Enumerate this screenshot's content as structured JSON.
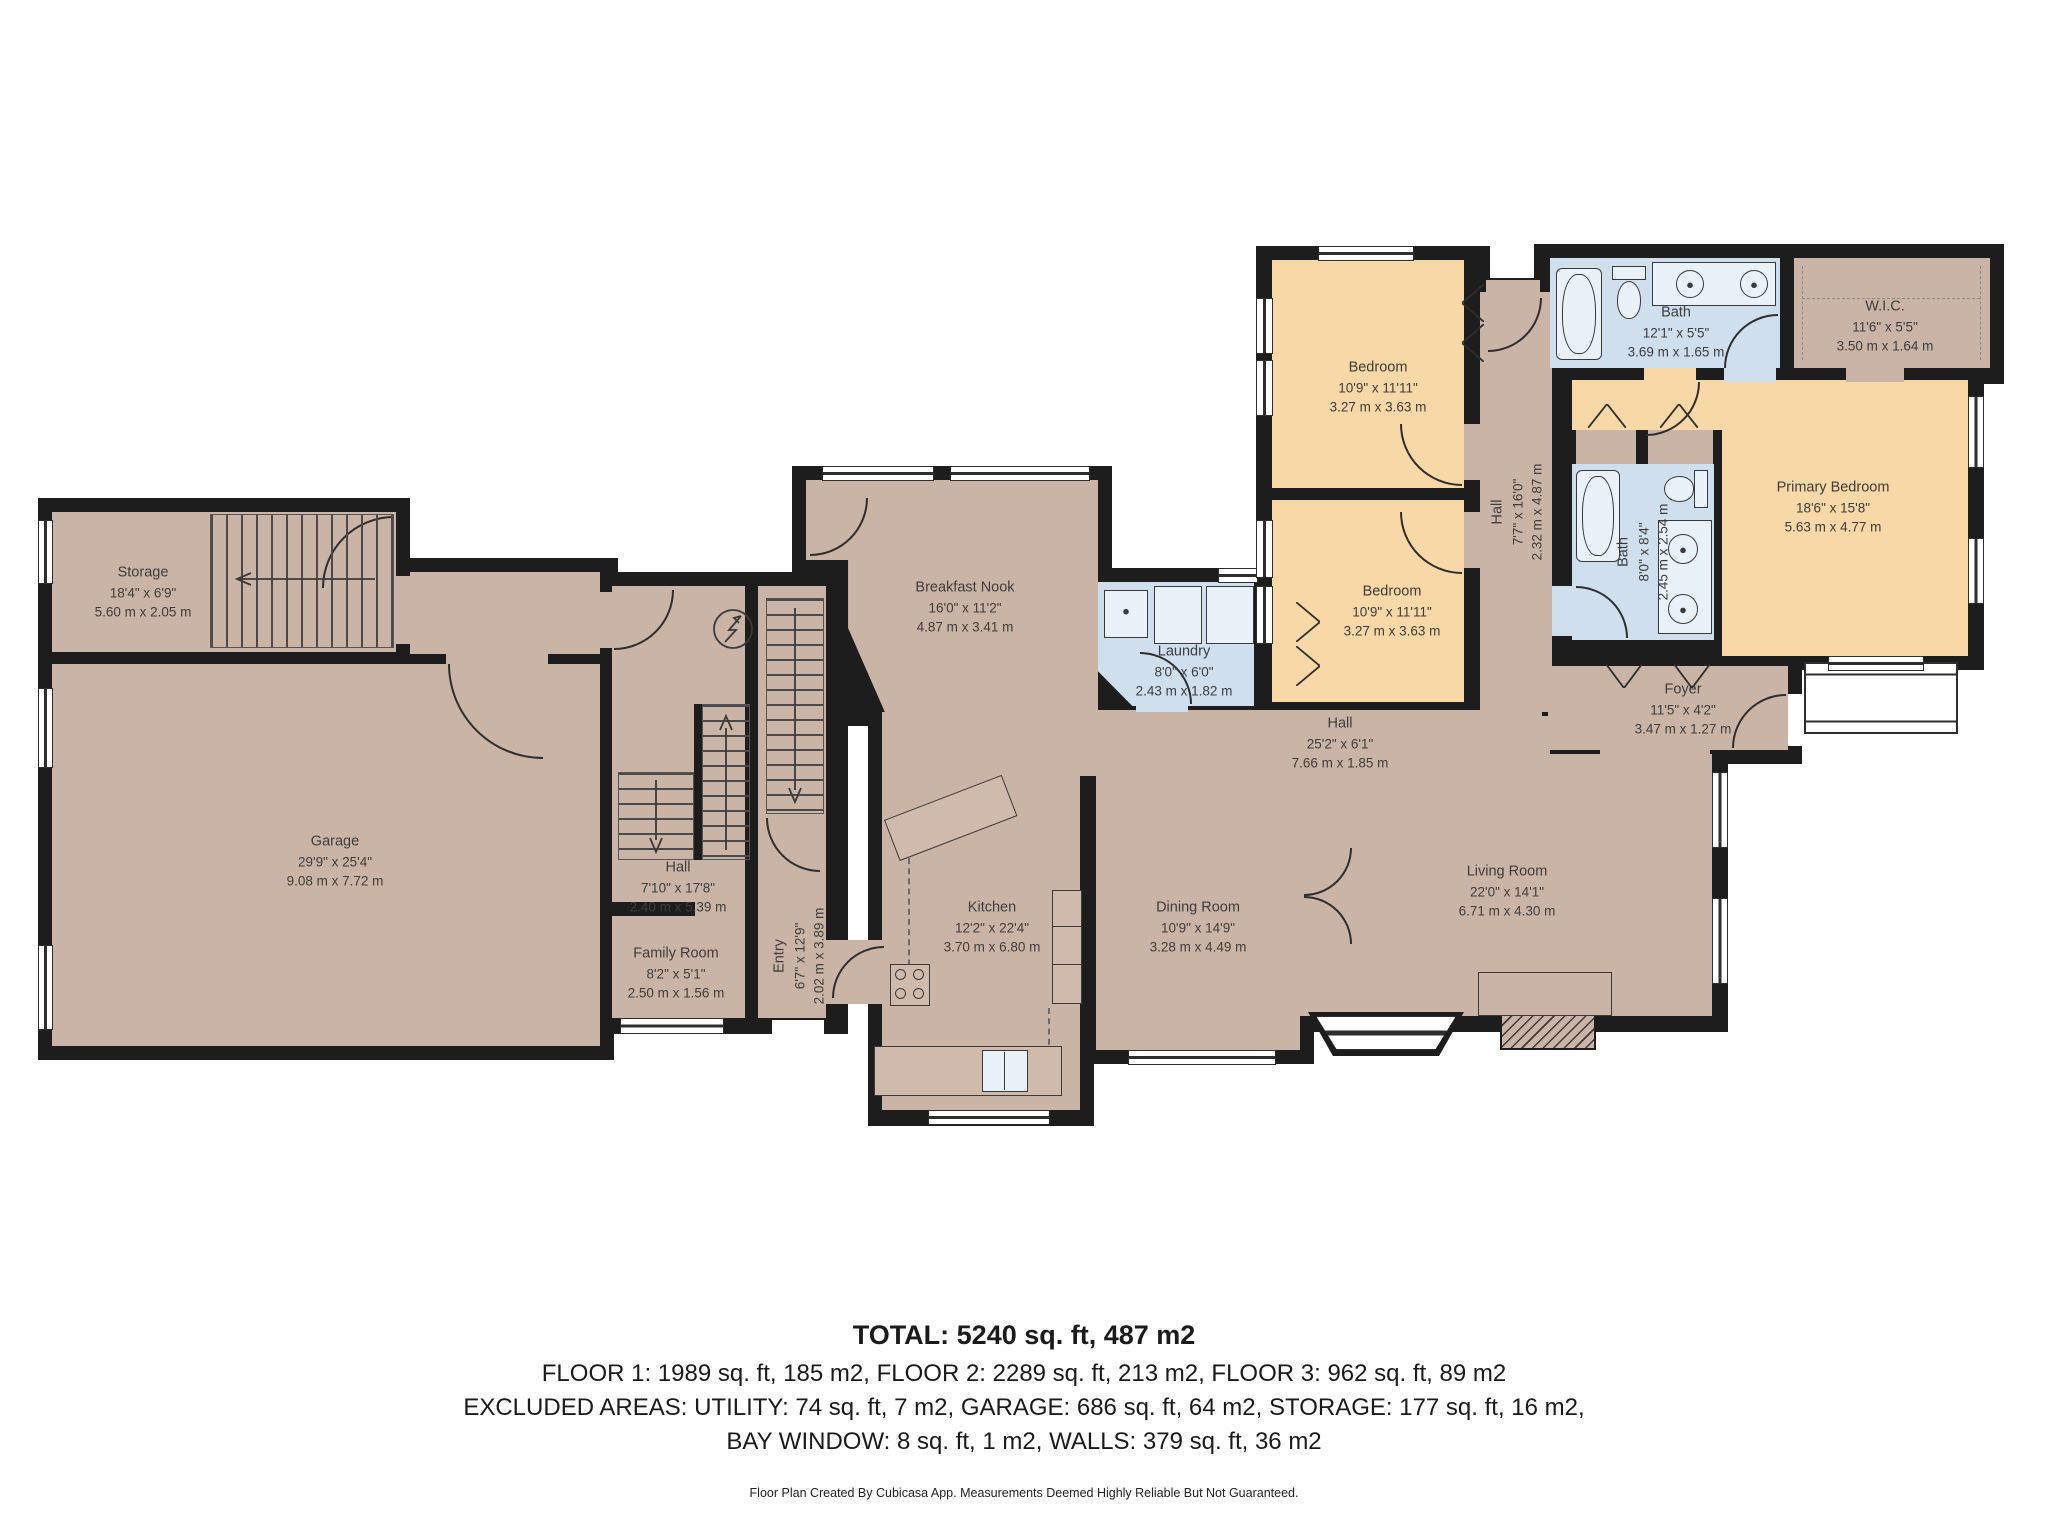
{
  "colors": {
    "wall": "#1d1d1d",
    "room": "#cab4a6",
    "bedroom": "#f7d8a6",
    "wet": "#cfdfee",
    "text": "#3d3d3d"
  },
  "rooms": {
    "storage": {
      "name": "Storage",
      "imperial": "18'4\" x 6'9\"",
      "metric": "5.60 m x 2.05 m"
    },
    "garage": {
      "name": "Garage",
      "imperial": "29'9\" x 25'4\"",
      "metric": "9.08 m x 7.72 m"
    },
    "hall_left": {
      "name": "Hall",
      "imperial": "7'10\" x 17'8\"",
      "metric": "2.40 m x 5.39 m"
    },
    "family_room": {
      "name": "Family Room",
      "imperial": "8'2\" x 5'1\"",
      "metric": "2.50 m x 1.56 m"
    },
    "entry": {
      "name": "Entry",
      "imperial": "6'7\" x 12'9\"",
      "metric": "2.02 m x 3.89 m"
    },
    "breakfast_nook": {
      "name": "Breakfast Nook",
      "imperial": "16'0\" x 11'2\"",
      "metric": "4.87 m x 3.41 m"
    },
    "kitchen": {
      "name": "Kitchen",
      "imperial": "12'2\" x 22'4\"",
      "metric": "3.70 m x 6.80 m"
    },
    "laundry": {
      "name": "Laundry",
      "imperial": "8'0\" x 6'0\"",
      "metric": "2.43 m x 1.82 m"
    },
    "hall_main": {
      "name": "Hall",
      "imperial": "25'2\" x 6'1\"",
      "metric": "7.66 m x 1.85 m"
    },
    "dining_room": {
      "name": "Dining Room",
      "imperial": "10'9\" x 14'9\"",
      "metric": "3.28 m x 4.49 m"
    },
    "living_room": {
      "name": "Living Room",
      "imperial": "22'0\" x 14'1\"",
      "metric": "6.71 m x 4.30 m"
    },
    "bedroom_1": {
      "name": "Bedroom",
      "imperial": "10'9\" x 11'11\"",
      "metric": "3.27 m x 3.63 m"
    },
    "bedroom_2": {
      "name": "Bedroom",
      "imperial": "10'9\" x 11'11\"",
      "metric": "3.27 m x 3.63 m"
    },
    "hall_upper": {
      "name": "Hall",
      "imperial": "7'7\" x 16'0\"",
      "metric": "2.32 m x 4.87 m"
    },
    "bath_main": {
      "name": "Bath",
      "imperial": "12'1\" x 5'5\"",
      "metric": "3.69 m x 1.65 m"
    },
    "wic": {
      "name": "W.I.C.",
      "imperial": "11'6\" x 5'5\"",
      "metric": "3.50 m x 1.64 m"
    },
    "bath_primary": {
      "name": "Bath",
      "imperial": "8'0\" x 8'4\"",
      "metric": "2.45 m x 2.54 m"
    },
    "primary_bedroom": {
      "name": "Primary Bedroom",
      "imperial": "18'6\" x 15'8\"",
      "metric": "5.63 m x 4.77 m"
    },
    "foyer": {
      "name": "Foyer",
      "imperial": "11'5\" x 4'2\"",
      "metric": "3.47 m x 1.27 m"
    }
  },
  "summary": {
    "total": "TOTAL: 5240 sq. ft, 487 m2",
    "floors": "FLOOR 1: 1989 sq. ft, 185 m2, FLOOR 2: 2289 sq. ft, 213 m2, FLOOR 3: 962 sq. ft, 89 m2",
    "excluded_1": "EXCLUDED AREAS: UTILITY: 74 sq. ft, 7 m2, GARAGE: 686 sq. ft, 64 m2, STORAGE: 177 sq. ft, 16 m2,",
    "excluded_2": "BAY WINDOW: 8 sq. ft, 1 m2, WALLS: 379 sq. ft, 36 m2",
    "disclaimer": "Floor Plan Created By Cubicasa App. Measurements Deemed Highly Reliable But Not Guaranteed."
  }
}
